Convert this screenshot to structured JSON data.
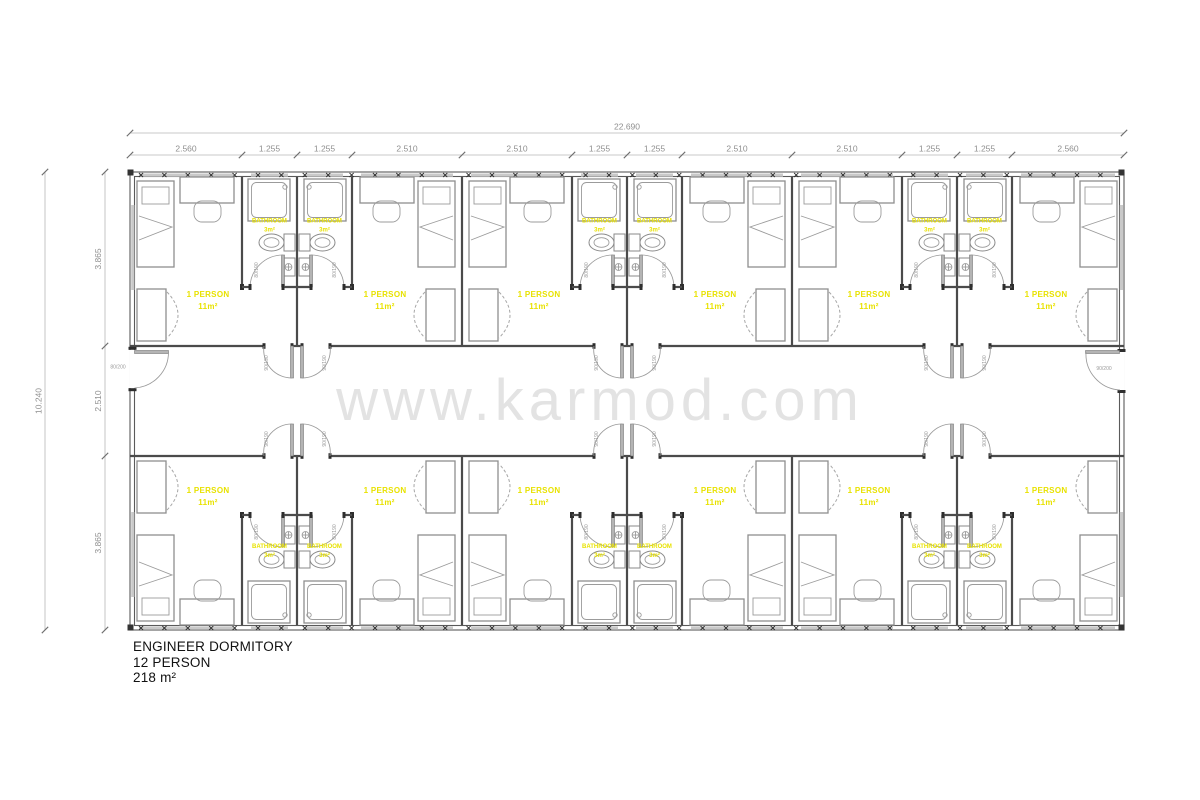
{
  "watermark": {
    "text": "www.karmod.com"
  },
  "title_block": {
    "line1": "ENGINEER DORMITORY",
    "line2": "12 PERSON",
    "line3": "218 m²"
  },
  "dimensions": {
    "total_width_label": "22.690",
    "total_height_label": "10.240",
    "top_segment_labels": [
      "2.560",
      "1.255",
      "1.255",
      "2.510",
      "2.510",
      "1.255",
      "1.255",
      "2.510",
      "2.510",
      "1.255",
      "1.255",
      "2.560"
    ],
    "left_segment_labels": [
      "3.865",
      "2.510",
      "3.865"
    ]
  },
  "rooms": {
    "count": 12,
    "label_line1": "1 PERSON",
    "label_line2": "11m²"
  },
  "bathrooms": {
    "count": 12,
    "label_line1": "BATHROOM",
    "label_line2": "3m²"
  },
  "door_labels": {
    "entry_left": "80/200",
    "entry_right": "90/200",
    "room": "90/190",
    "bathroom": "80/190"
  },
  "colors": {
    "label_yellow": "#e8e200",
    "dimension_text": "#8f8f8f",
    "wall": "#4b4b4b",
    "furniture": "#8e8e8e",
    "window_band": "#c9c9c9",
    "watermark": "#e3e3e3",
    "door_leaf": "#b4b4b4",
    "title_text": "#111111"
  }
}
